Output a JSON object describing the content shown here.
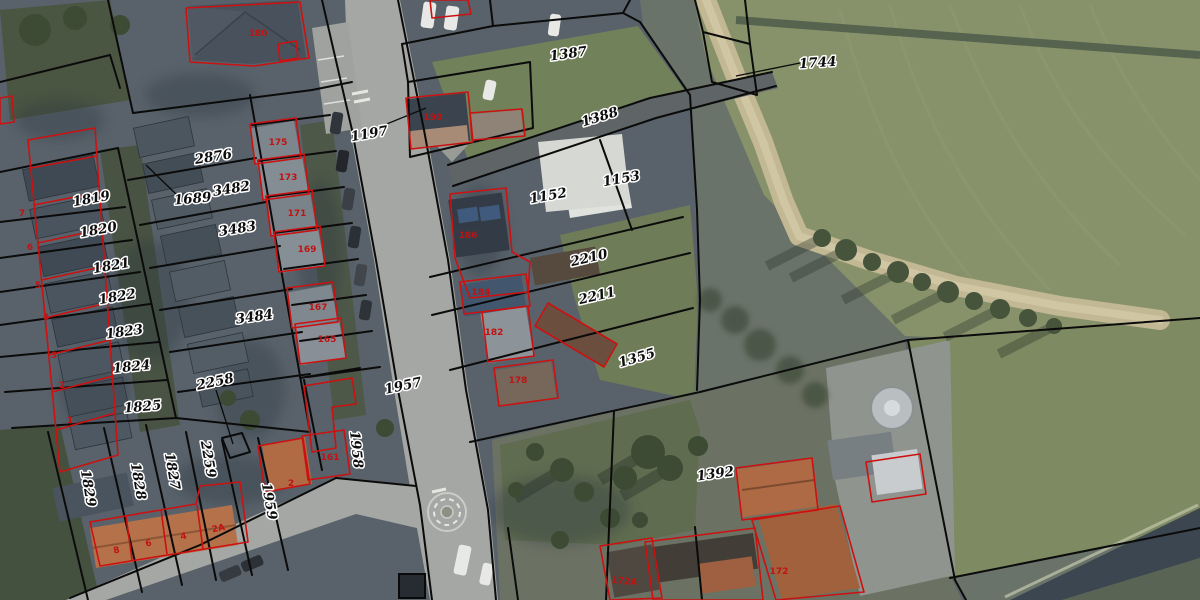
{
  "map": {
    "kind": "cadastral-aerial-map",
    "colors": {
      "parcel_line": "#0b0b0b",
      "building_outline": "#cc1111",
      "house_number_text": "#bf1313",
      "parcel_label_text": "#0d0d0d",
      "parcel_label_halo": "#ffffff",
      "field_green": "#87926b",
      "water": "#3c4650",
      "road": "#a4a7a3"
    },
    "parcel_labels": [
      {
        "text": "1819",
        "x": 92,
        "y": 203,
        "rot": -10
      },
      {
        "text": "1820",
        "x": 99,
        "y": 234,
        "rot": -10
      },
      {
        "text": "1821",
        "x": 112,
        "y": 270,
        "rot": -10
      },
      {
        "text": "1822",
        "x": 118,
        "y": 301,
        "rot": -10
      },
      {
        "text": "1823",
        "x": 125,
        "y": 336,
        "rot": -8
      },
      {
        "text": "1824",
        "x": 132,
        "y": 371,
        "rot": -6
      },
      {
        "text": "1825",
        "x": 143,
        "y": 411,
        "rot": -5
      },
      {
        "text": "1829",
        "x": 84,
        "y": 489,
        "rot": 80
      },
      {
        "text": "1828",
        "x": 134,
        "y": 482,
        "rot": 80
      },
      {
        "text": "1827",
        "x": 168,
        "y": 472,
        "rot": 80
      },
      {
        "text": "2259",
        "x": 204,
        "y": 460,
        "rot": 80
      },
      {
        "text": "1959",
        "x": 265,
        "y": 502,
        "rot": 80
      },
      {
        "text": "1958",
        "x": 352,
        "y": 450,
        "rot": 84
      },
      {
        "text": "2876",
        "x": 214,
        "y": 161,
        "rot": -9
      },
      {
        "text": "3482",
        "x": 232,
        "y": 193,
        "rot": -9
      },
      {
        "text": "1689",
        "x": 193,
        "y": 203,
        "rot": -5
      },
      {
        "text": "3483",
        "x": 238,
        "y": 233,
        "rot": -9
      },
      {
        "text": "3484",
        "x": 255,
        "y": 321,
        "rot": -8
      },
      {
        "text": "2258",
        "x": 216,
        "y": 386,
        "rot": -12
      },
      {
        "text": "1197",
        "x": 370,
        "y": 138,
        "rot": -10
      },
      {
        "text": "1957",
        "x": 404,
        "y": 390,
        "rot": -12
      },
      {
        "text": "1387",
        "x": 569,
        "y": 58,
        "rot": -8
      },
      {
        "text": "1388",
        "x": 601,
        "y": 121,
        "rot": -17
      },
      {
        "text": "1152",
        "x": 549,
        "y": 200,
        "rot": -10
      },
      {
        "text": "1153",
        "x": 622,
        "y": 183,
        "rot": -10
      },
      {
        "text": "2210",
        "x": 590,
        "y": 262,
        "rot": -13
      },
      {
        "text": "2211",
        "x": 598,
        "y": 300,
        "rot": -13
      },
      {
        "text": "1355",
        "x": 638,
        "y": 362,
        "rot": -16
      },
      {
        "text": "1392",
        "x": 716,
        "y": 478,
        "rot": -8
      },
      {
        "text": "1744",
        "x": 818,
        "y": 67,
        "rot": -4
      }
    ],
    "house_number_labels": [
      {
        "text": "180",
        "x": 258,
        "y": 36,
        "rot": 0
      },
      {
        "text": "175",
        "x": 278,
        "y": 145,
        "rot": 0
      },
      {
        "text": "173",
        "x": 288,
        "y": 180,
        "rot": 0
      },
      {
        "text": "171",
        "x": 297,
        "y": 216,
        "rot": 0
      },
      {
        "text": "169",
        "x": 307,
        "y": 252,
        "rot": 0
      },
      {
        "text": "167",
        "x": 318,
        "y": 310,
        "rot": 0
      },
      {
        "text": "165",
        "x": 327,
        "y": 342,
        "rot": 0
      },
      {
        "text": "161",
        "x": 330,
        "y": 460,
        "rot": 0
      },
      {
        "text": "7",
        "x": 22,
        "y": 216,
        "rot": 0
      },
      {
        "text": "6",
        "x": 30,
        "y": 250,
        "rot": 0
      },
      {
        "text": "5",
        "x": 38,
        "y": 288,
        "rot": 0
      },
      {
        "text": "4",
        "x": 46,
        "y": 320,
        "rot": 0
      },
      {
        "text": "3",
        "x": 54,
        "y": 358,
        "rot": 0
      },
      {
        "text": "2",
        "x": 62,
        "y": 388,
        "rot": 0
      },
      {
        "text": "1",
        "x": 70,
        "y": 423,
        "rot": 0
      },
      {
        "text": "8",
        "x": 117,
        "y": 553,
        "rot": -12
      },
      {
        "text": "6",
        "x": 149,
        "y": 546,
        "rot": -12
      },
      {
        "text": "4",
        "x": 184,
        "y": 539,
        "rot": -12
      },
      {
        "text": "2A",
        "x": 219,
        "y": 531,
        "rot": -12
      },
      {
        "text": "2",
        "x": 291,
        "y": 486,
        "rot": 0
      },
      {
        "text": "190",
        "x": 433,
        "y": 120,
        "rot": 0
      },
      {
        "text": "186",
        "x": 468,
        "y": 238,
        "rot": 0
      },
      {
        "text": "184",
        "x": 481,
        "y": 295,
        "rot": 0
      },
      {
        "text": "182",
        "x": 494,
        "y": 335,
        "rot": 0
      },
      {
        "text": "178",
        "x": 518,
        "y": 383,
        "rot": 0
      },
      {
        "text": "172A",
        "x": 624,
        "y": 584,
        "rot": 6
      },
      {
        "text": "172",
        "x": 779,
        "y": 574,
        "rot": 0
      }
    ]
  }
}
